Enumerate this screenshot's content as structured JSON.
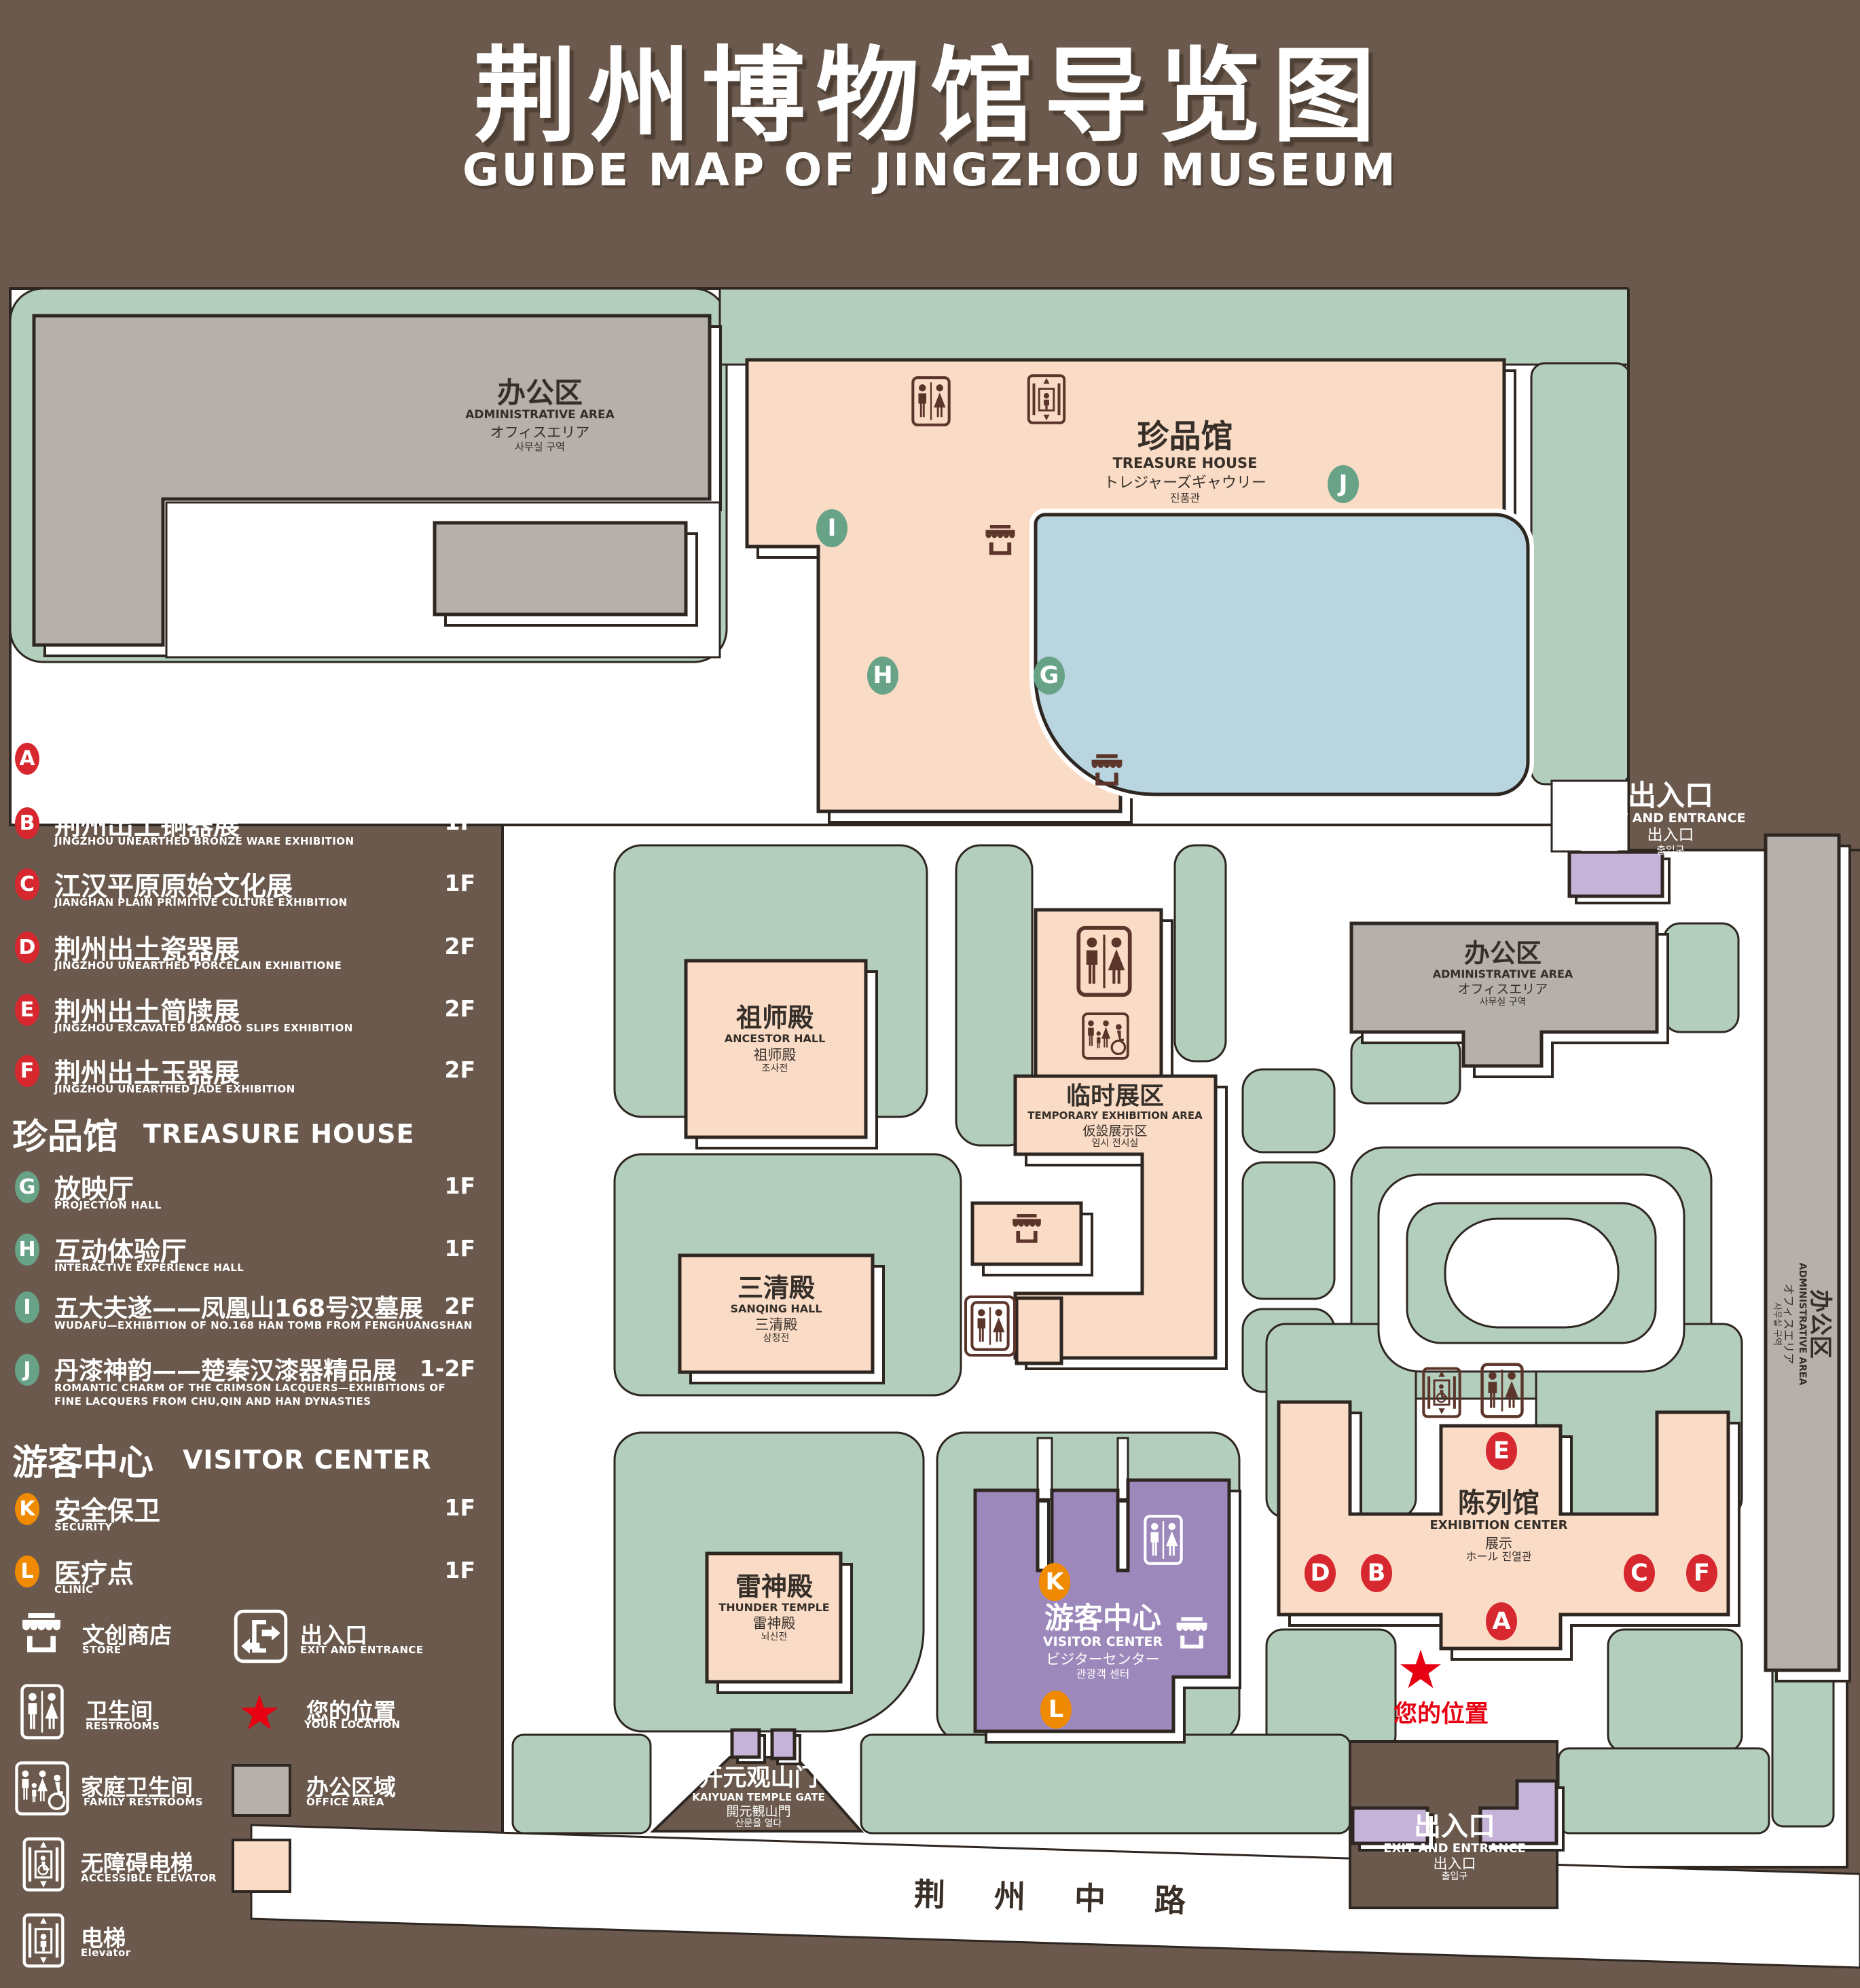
{
  "title": {
    "zh": "荆州博物馆导览图",
    "en": "GUIDE MAP OF JINGZHOU MUSEUM"
  },
  "legend": {
    "sections": [
      {
        "zh": "陈列馆",
        "en": "EXHIBITION CENTER",
        "badge_color": "#d7282f",
        "items": [
          {
            "letter": "A",
            "zh": "《火中的凤凰》壁画",
            "en": "THE PHOENIX IN FIRE \"MURAL PAINTING",
            "floor": "1F"
          },
          {
            "letter": "B",
            "zh": "荆州出土铜器展",
            "en": "JINGZHOU UNEARTHED BRONZE WARE EXHIBITION",
            "floor": "1F"
          },
          {
            "letter": "C",
            "zh": "江汉平原原始文化展",
            "en": "JIANGHAN PLAIN PRIMITIVE CULTURE EXHIBITION",
            "floor": "1F"
          },
          {
            "letter": "D",
            "zh": "荆州出土瓷器展",
            "en": "JINGZHOU UNEARTHED PORCELAIN EXHIBITIONE",
            "floor": "2F"
          },
          {
            "letter": "E",
            "zh": "荆州出土简牍展",
            "en": "JINGZHOU EXCAVATED BAMBOO SLIPS EXHIBITION",
            "floor": "2F"
          },
          {
            "letter": "F",
            "zh": "荆州出土玉器展",
            "en": "JINGZHOU UNEARTHED JADE EXHIBITION",
            "floor": "2F"
          }
        ]
      },
      {
        "zh": "珍品馆",
        "en": "TREASURE HOUSE",
        "badge_color": "#68a287",
        "items": [
          {
            "letter": "G",
            "zh": "放映厅",
            "en": "PROJECTION HALL",
            "floor": "1F"
          },
          {
            "letter": "H",
            "zh": "互动体验厅",
            "en": "INTERACTIVE EXPERIENCE HALL",
            "floor": "1F"
          },
          {
            "letter": "I",
            "zh": "五大夫遂——凤凰山168号汉墓展",
            "en": "WUDAFU—EXHIBITION OF NO.168 HAN TOMB FROM FENGHUANGSHAN",
            "floor": "2F"
          },
          {
            "letter": "J",
            "zh": "丹漆神韵——楚秦汉漆器精品展",
            "en": "ROMANTIC CHARM OF THE CRIMSON LACQUERS—EXHIBITIONS OF FINE LACQUERS FROM CHU,QIN AND HAN DYNASTIES",
            "floor": "1-2F"
          }
        ]
      },
      {
        "zh": "游客中心",
        "en": "VISITOR CENTER",
        "badge_color": "#f08a00",
        "items": [
          {
            "letter": "K",
            "zh": "安全保卫",
            "en": "SECURITY",
            "floor": "1F"
          },
          {
            "letter": "L",
            "zh": "医疗点",
            "en": "CLINIC",
            "floor": "1F"
          }
        ]
      }
    ],
    "symbols": {
      "store": {
        "zh": "文创商店",
        "en": "STORE"
      },
      "exit": {
        "zh": "出入口",
        "en": "EXIT AND ENTRANCE"
      },
      "restrooms": {
        "zh": "卫生间",
        "en": "RESTROOMS"
      },
      "location": {
        "zh": "您的位置",
        "en": "YOUR LOCATION"
      },
      "family": {
        "zh": "家庭卫生间",
        "en": "FAMILY RESTROOMS"
      },
      "office": {
        "zh": "办公区域",
        "en": "OFFICE AREA"
      },
      "accessible": {
        "zh": "无障碍电梯",
        "en": "ACCESSIBLE ELEVATOR"
      },
      "display": {
        "zh": "展示区域",
        "en": "DISPLAY AREA"
      },
      "elevator": {
        "zh": "电梯",
        "en": "Elevator"
      }
    }
  },
  "map": {
    "labels": {
      "admin": {
        "zh": "办公区",
        "en": "ADMINISTRATIVE AREA",
        "jp": "オフィスエリア",
        "kr": "사무실 구역"
      },
      "treasure": {
        "zh": "珍品馆",
        "en": "TREASURE HOUSE",
        "jp": "トレジャーズギャウリー",
        "kr": "진품관"
      },
      "ancestor": {
        "zh": "祖师殿",
        "en": "ANCESTOR HALL",
        "jp": "祖师殿",
        "kr": "조사전"
      },
      "temporary": {
        "zh": "临时展区",
        "en": "TEMPORARY EXHIBITION AREA",
        "jp": "仮設展示区",
        "kr": "임시 전시실"
      },
      "sanqing": {
        "zh": "三清殿",
        "en": "SANQING HALL",
        "jp": "三清殿",
        "kr": "삼청전"
      },
      "thunder": {
        "zh": "雷神殿",
        "en": "THUNDER TEMPLE",
        "jp": "雷神殿",
        "kr": "뇌신전"
      },
      "visitor": {
        "zh": "游客中心",
        "en": "VISITOR CENTER",
        "jp": "ビジターセンター",
        "kr": "관광객 센터"
      },
      "exhibition": {
        "zh": "陈列馆",
        "en": "EXHIBITION CENTER",
        "jp": "展示",
        "kr": "ホール 진열관"
      },
      "gate": {
        "zh": "开元观山门",
        "en": "KAIYUAN TEMPLE GATE",
        "jp": "開元観山門",
        "kr": "산문을 열다"
      },
      "exit": {
        "zh": "出入口",
        "en": "EXIT AND ENTRANCE",
        "jp": "出入口",
        "kr": "출입구"
      },
      "road": "荆 州 中 路",
      "your_location": "您的位置"
    },
    "badge_letters": {
      "A": "A",
      "B": "B",
      "C": "C",
      "D": "D",
      "E": "E",
      "F": "F",
      "G": "G",
      "H": "H",
      "I": "I",
      "J": "J",
      "K": "K",
      "L": "L"
    },
    "icons": {
      "star": "★"
    },
    "colors": {
      "background": "#6a594c",
      "green": "#b4cebd",
      "display_area": "#fadcc6",
      "office_area": "#b5b0ab",
      "pond": "#b9d6e0",
      "visitor_purple": "#9d88bb",
      "light_purple": "#c6b3d8",
      "badge_red": "#d7282f",
      "badge_green": "#68a287",
      "badge_orange": "#f08a00",
      "location_red": "#e60012",
      "icon_brown": "#5c352a"
    }
  }
}
